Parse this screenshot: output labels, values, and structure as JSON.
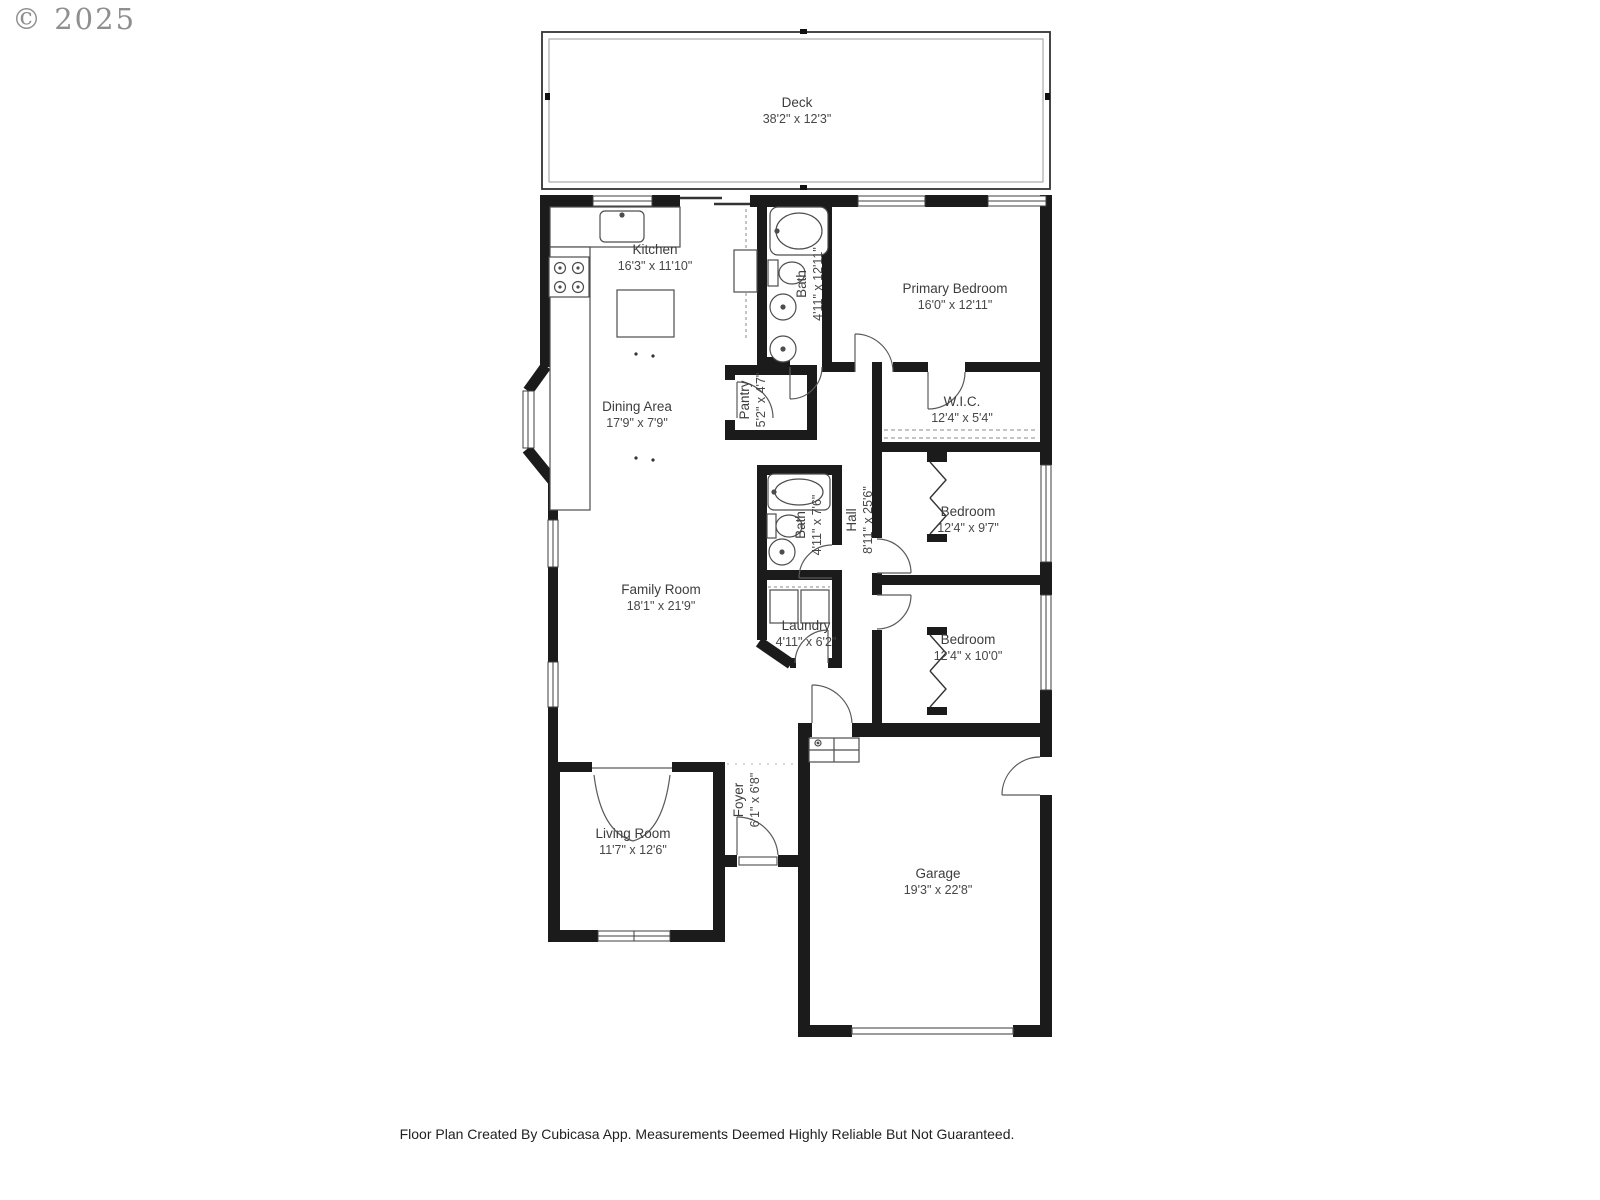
{
  "page": {
    "copyright": "© 2025",
    "footer": "Floor Plan Created By Cubicasa App. Measurements Deemed Highly Reliable But Not Guaranteed."
  },
  "rooms": [
    {
      "id": "deck",
      "name": "Deck",
      "dims": "38'2\" x 12'3\""
    },
    {
      "id": "kitchen",
      "name": "Kitchen",
      "dims": "16'3\" x 11'10\""
    },
    {
      "id": "primary-bath",
      "name": "Bath",
      "dims": "4'11\" x 12'11\""
    },
    {
      "id": "primary-bedroom",
      "name": "Primary Bedroom",
      "dims": "16'0\" x 12'11\""
    },
    {
      "id": "pantry",
      "name": "Pantry",
      "dims": "5'2\" x 4'7\""
    },
    {
      "id": "wic",
      "name": "W.I.C.",
      "dims": "12'4\" x 5'4\""
    },
    {
      "id": "dining-area",
      "name": "Dining Area",
      "dims": "17'9\" x 7'9\""
    },
    {
      "id": "hall-bath",
      "name": "Bath",
      "dims": "4'11\" x 7'6\""
    },
    {
      "id": "hall",
      "name": "Hall",
      "dims": "8'11\" x 25'6\""
    },
    {
      "id": "bedroom-2",
      "name": "Bedroom",
      "dims": "12'4\" x 9'7\""
    },
    {
      "id": "family-room",
      "name": "Family Room",
      "dims": "18'1\" x 21'9\""
    },
    {
      "id": "laundry",
      "name": "Laundry",
      "dims": "4'11\" x 6'2\""
    },
    {
      "id": "bedroom-3",
      "name": "Bedroom",
      "dims": "12'4\" x 10'0\""
    },
    {
      "id": "living-room",
      "name": "Living Room",
      "dims": "11'7\" x 12'6\""
    },
    {
      "id": "foyer",
      "name": "Foyer",
      "dims": "6'1\" x 6'8\""
    },
    {
      "id": "garage",
      "name": "Garage",
      "dims": "19'3\" x 22'8\""
    }
  ],
  "colors": {
    "wall": "#1b1b1b",
    "fixture": "#4d4d4d",
    "label": "#3d3d3d",
    "copyright": "#8f8f8f"
  }
}
